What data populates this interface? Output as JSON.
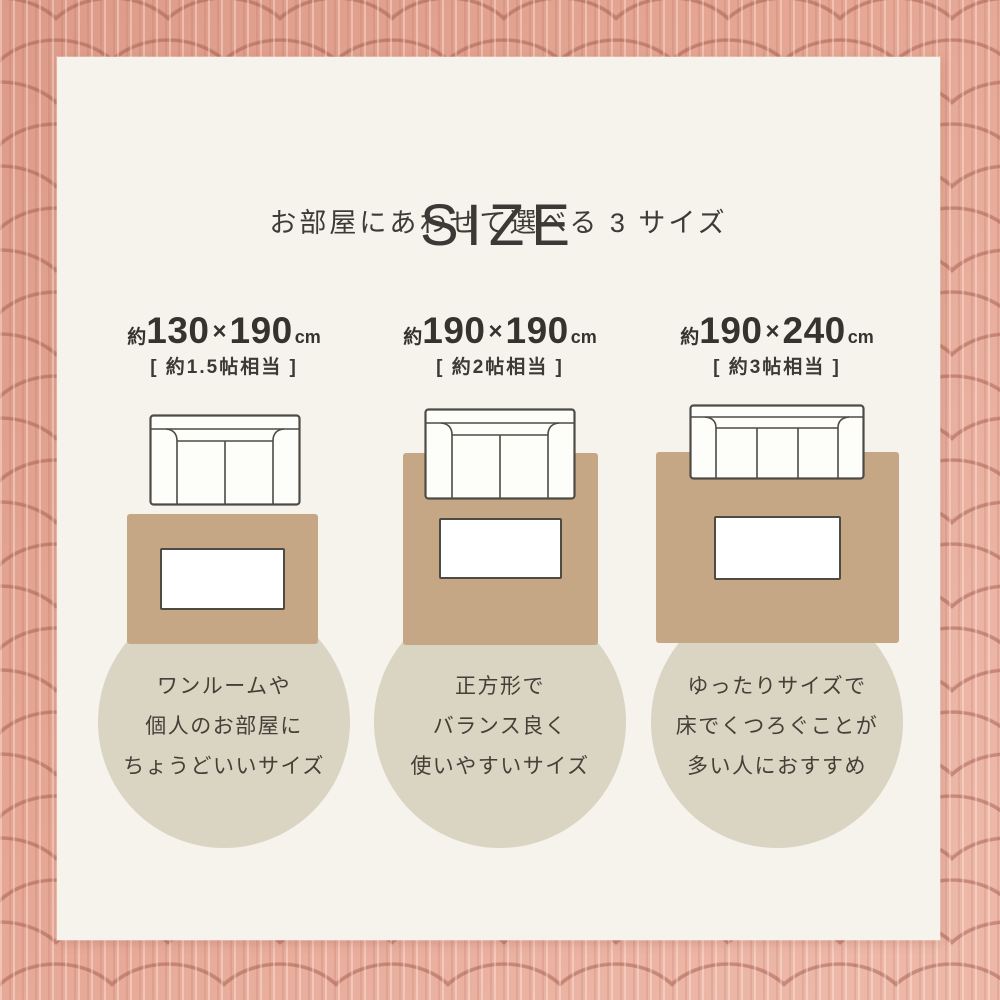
{
  "page": {
    "title": "SIZE",
    "subtitle": "お部屋にあわせて選べる 3 サイズ"
  },
  "colors": {
    "border_pink": "#E6A795",
    "quilt_stitch": "#A35C4B",
    "panel_bg": "#F6F3ED",
    "rug_tan": "#C5A785",
    "circle_beige": "#DAD4C3",
    "text_dark": "#3A3936",
    "outline_dark": "#4E4B45",
    "table_white": "#FFFFFF"
  },
  "sizes": [
    {
      "approx": "約",
      "width_cm": "130",
      "times": "×",
      "depth_cm": "190",
      "unit": "cm",
      "tatami": "[ 約1.5帖相当 ]",
      "lines": [
        "ワンルームや",
        "個人のお部屋に",
        "ちょうどいいサイズ"
      ],
      "sofa_seats": 2
    },
    {
      "approx": "約",
      "width_cm": "190",
      "times": "×",
      "depth_cm": "190",
      "unit": "cm",
      "tatami": "[ 約2帖相当 ]",
      "lines": [
        "正方形で",
        "バランス良く",
        "使いやすいサイズ"
      ],
      "sofa_seats": 2
    },
    {
      "approx": "約",
      "width_cm": "190",
      "times": "×",
      "depth_cm": "240",
      "unit": "cm",
      "tatami": "[ 約3帖相当 ]",
      "lines": [
        "ゆったりサイズで",
        "床でくつろぐことが",
        "多い人におすすめ"
      ],
      "sofa_seats": 3
    }
  ]
}
